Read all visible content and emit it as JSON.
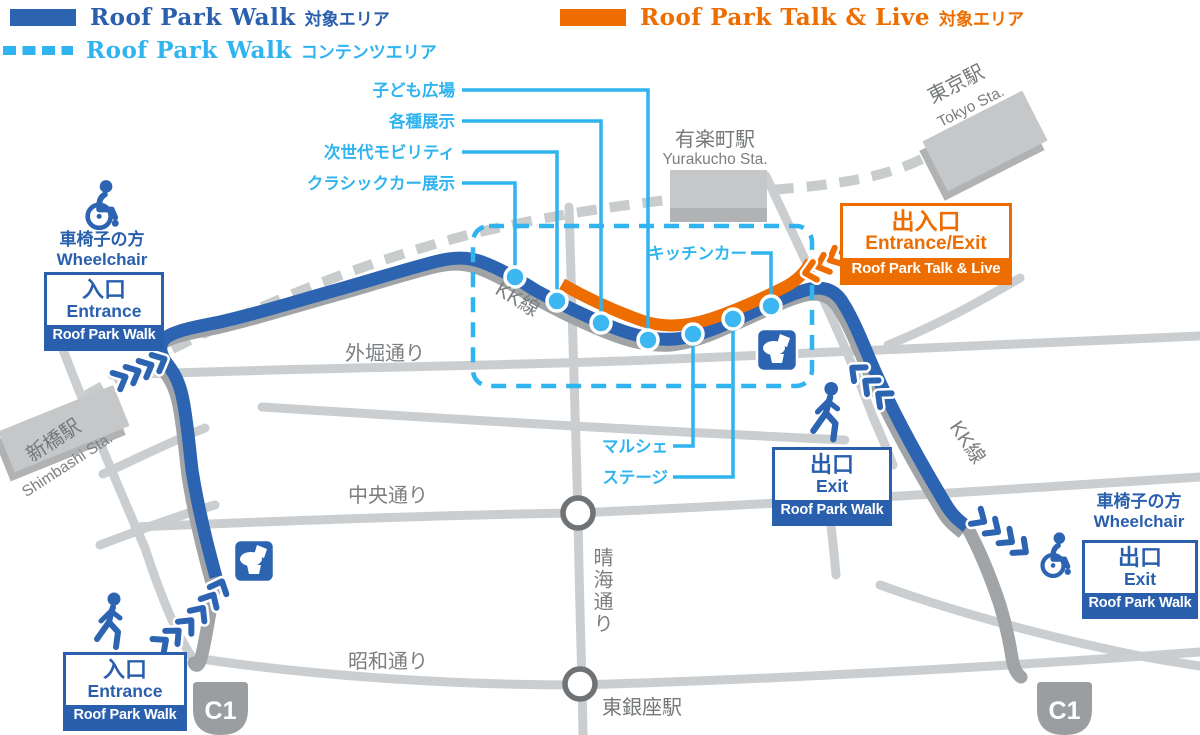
{
  "colors": {
    "walk_blue": "#2d64b2",
    "box_blue": "#2a5fae",
    "content_lightblue": "#2fb4ef",
    "talklive_orange": "#ed6d00",
    "road_gray": "#cbced0",
    "kk_shadow_gray": "#a0a4a6",
    "label_gray": "#7b7e80"
  },
  "legend": {
    "walk_area": {
      "title": "Roof Park Walk",
      "suffix": "対象エリア"
    },
    "walk_content": {
      "title": "Roof Park Walk",
      "suffix": "コンテンツエリア"
    },
    "talklive_area": {
      "title": "Roof Park Talk & Live",
      "suffix": "対象エリア"
    }
  },
  "stations": {
    "tokyo": {
      "jp": "東京駅",
      "en": "Tokyo Sta."
    },
    "yurakucho": {
      "jp": "有楽町駅",
      "en": "Yurakucho Sta."
    },
    "shimbashi": {
      "jp": "新橋駅",
      "en": "Shimbashi Sta."
    },
    "higashi_ginza": {
      "jp": "東銀座駅"
    }
  },
  "roads": {
    "sotobori": "外堀通り",
    "chuo": "中央通り",
    "showa": "昭和通り",
    "harumi": "晴海通り",
    "kk": "KK線"
  },
  "callouts": {
    "kids_plaza": "子ども広場",
    "exhibitions": "各種展示",
    "mobility": "次世代モビリティ",
    "classic_car": "クラシックカー展示",
    "kitchen_car": "キッチンカー",
    "marche": "マルシェ",
    "stage": "ステージ"
  },
  "gates": {
    "wheelchair_entrance": {
      "heading_jp": "車椅子の方",
      "heading_en": "Wheelchair",
      "label_jp": "入口",
      "label_en": "Entrance",
      "event": "Roof Park Walk"
    },
    "south_entrance": {
      "label_jp": "入口",
      "label_en": "Entrance",
      "event": "Roof Park Walk"
    },
    "east_exit": {
      "label_jp": "出口",
      "label_en": "Exit",
      "event": "Roof Park Walk"
    },
    "wheelchair_exit": {
      "heading_jp": "車椅子の方",
      "heading_en": "Wheelchair",
      "label_jp": "出口",
      "label_en": "Exit",
      "event": "Roof Park Walk"
    },
    "talklive_gate": {
      "label_jp": "出入口",
      "label_en": "Entrance/Exit",
      "event": "Roof Park Talk & Live"
    }
  },
  "badges": {
    "c1": "C1"
  },
  "icons": {
    "toilet": "toilet-icon",
    "wheelchair": "wheelchair-icon",
    "walker": "walking-person-icon",
    "chevron": "chevron-arrow-icon"
  }
}
